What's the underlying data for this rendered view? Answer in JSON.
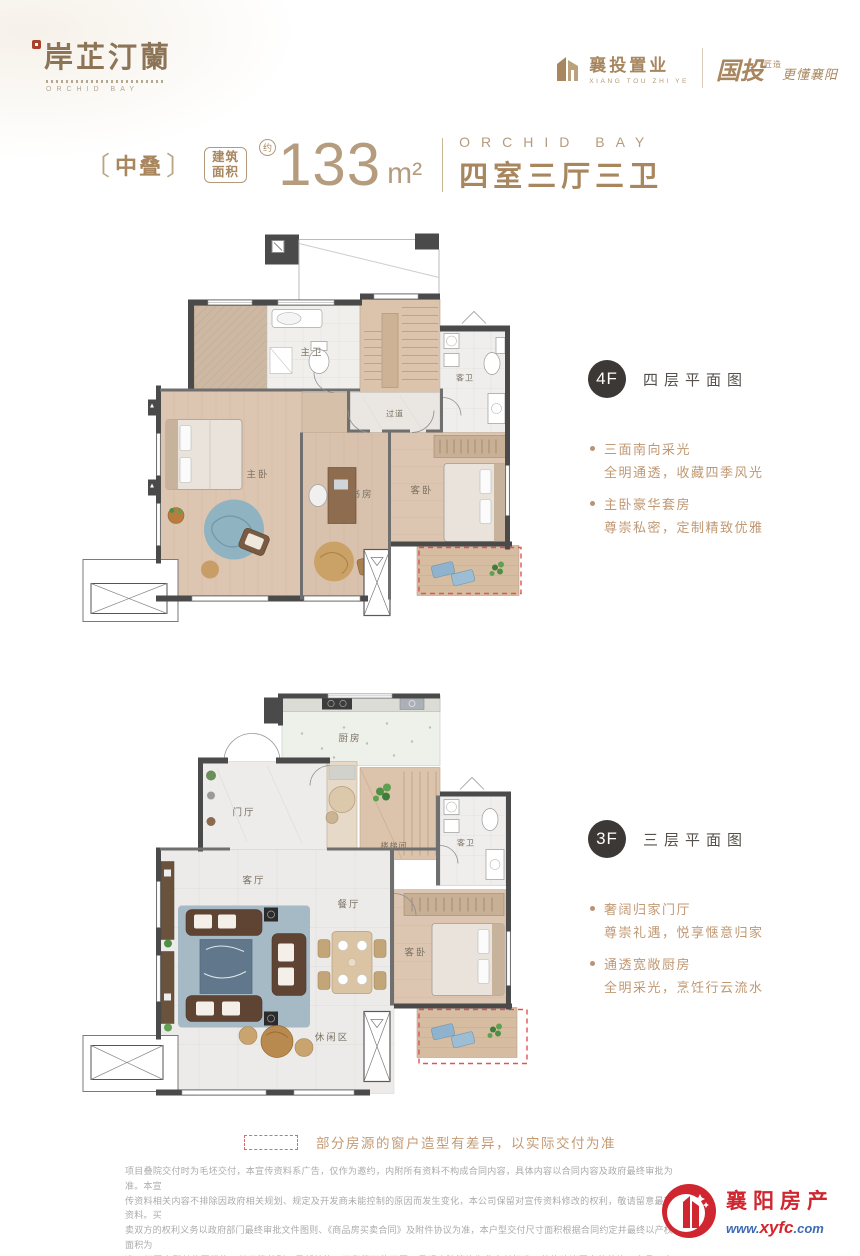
{
  "colors": {
    "accent_gold": "#a8875f",
    "area_tan": "#b59c7e",
    "badge_dark": "#3b3835",
    "bullet_tan": "#c09873",
    "dashed_red": "#e06a6a",
    "footer_red": "#cf2630",
    "url_blue": "#3f6ab4"
  },
  "brand": {
    "logo_cn": "岸芷汀蘭",
    "logo_en": "ORCHID BAY",
    "dev_name": "襄投置业",
    "dev_en": "XIANG TOU ZHI YE",
    "slogan_big": "国投",
    "slogan_small": "匠造",
    "slogan_rest": "更懂襄阳"
  },
  "title": {
    "bracket_open": "〔",
    "type_tag": "中叠",
    "bracket_close": "〕",
    "area_label_top": "建筑",
    "area_label_bottom": "面积",
    "approx_mark": "约",
    "area_value": "133",
    "area_unit": "m²",
    "project_en": "ORCHID BAY",
    "layout_cn": "四室三厅三卫"
  },
  "floors": [
    {
      "badge": "4F",
      "title": "四层平面图",
      "bullets": [
        {
          "head": "三面南向采光",
          "body": "全明通透，收藏四季风光"
        },
        {
          "head": "主卧豪华套房",
          "body": "尊崇私密，定制精致优雅"
        }
      ],
      "rooms": {
        "master_bath": "主卫",
        "corridor": "过道",
        "guest_bath": "客卫",
        "master_bedroom": "主卧",
        "study": "书房",
        "guest_bedroom": "客卧"
      }
    },
    {
      "badge": "3F",
      "title": "三层平面图",
      "bullets": [
        {
          "head": "奢阔归家门厅",
          "body": "尊崇礼遇，悦享惬意归家"
        },
        {
          "head": "通透宽敞厨房",
          "body": "全明采光，烹饪行云流水"
        }
      ],
      "rooms": {
        "kitchen": "厨房",
        "foyer": "门厅",
        "stairwell": "楼梯间",
        "guest_bath": "客卫",
        "living": "客厅",
        "dining": "餐厅",
        "guest_bedroom": "客卧",
        "leisure": "休闲区"
      }
    }
  ],
  "note": {
    "text": "部分房源的窗户造型有差异，以实际交付为准"
  },
  "disclaimer": {
    "lines": [
      "项目叠院交付时为毛坯交付，本宣传资料系广告，仅作为邀约，内附所有资料不构成合同内容，具体内容以合同内容及政府最终审批为准。本宣",
      "传资料相关内容不排除因政府相关规划、规定及开发商未能控制的原因而发生变化，本公司保留对宣传资料修改的权利，敬请留意最新资料。买",
      "卖双方的权利义务以政府部门最终审批文件图则、《商品房买卖合同》及附件协议为准，本户型交付尺寸面积根据合同约定并最终以产权面积为",
      "准，相同户型单位因楼栋、单元等差别，局部结构、面积等可能不同，景观庭院等均为非交付标准，装修建议图中的装饰、家具、家电、软装、",
      "阳台及设备平台等建筑空间的整改，仅为示意参考，具体以合同约定及政府审批为准。"
    ]
  },
  "footer": {
    "site_name": "襄阳房产",
    "url_www": "www.",
    "url_mid": "xyfc",
    "url_tld": ".com"
  }
}
